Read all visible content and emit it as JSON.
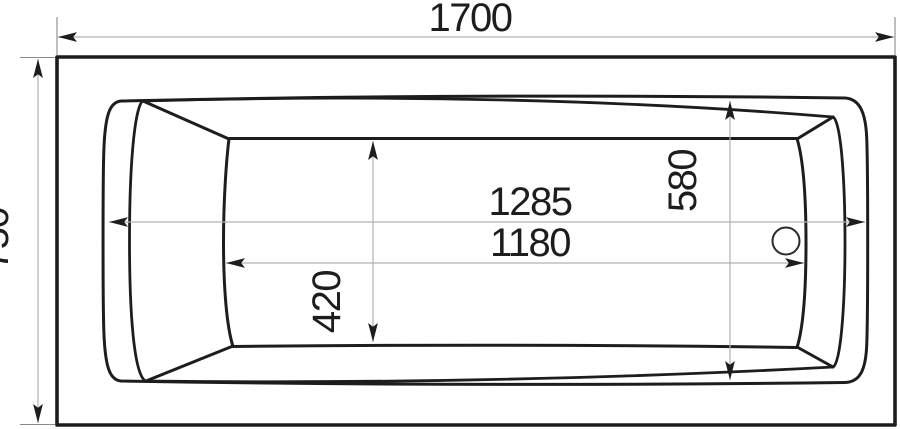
{
  "drawing": {
    "type": "technical-dimension-drawing",
    "subject": "bathtub top view",
    "background_color": "#ffffff",
    "contour_color": "#1d1d1b",
    "dimension_line_color": "#b2b2b2",
    "dimensions": {
      "overall_length": "1700",
      "overall_width": "750",
      "rim_opening_length": "1285",
      "floor_length": "1180",
      "rim_opening_width": "580",
      "floor_width": "420"
    }
  }
}
